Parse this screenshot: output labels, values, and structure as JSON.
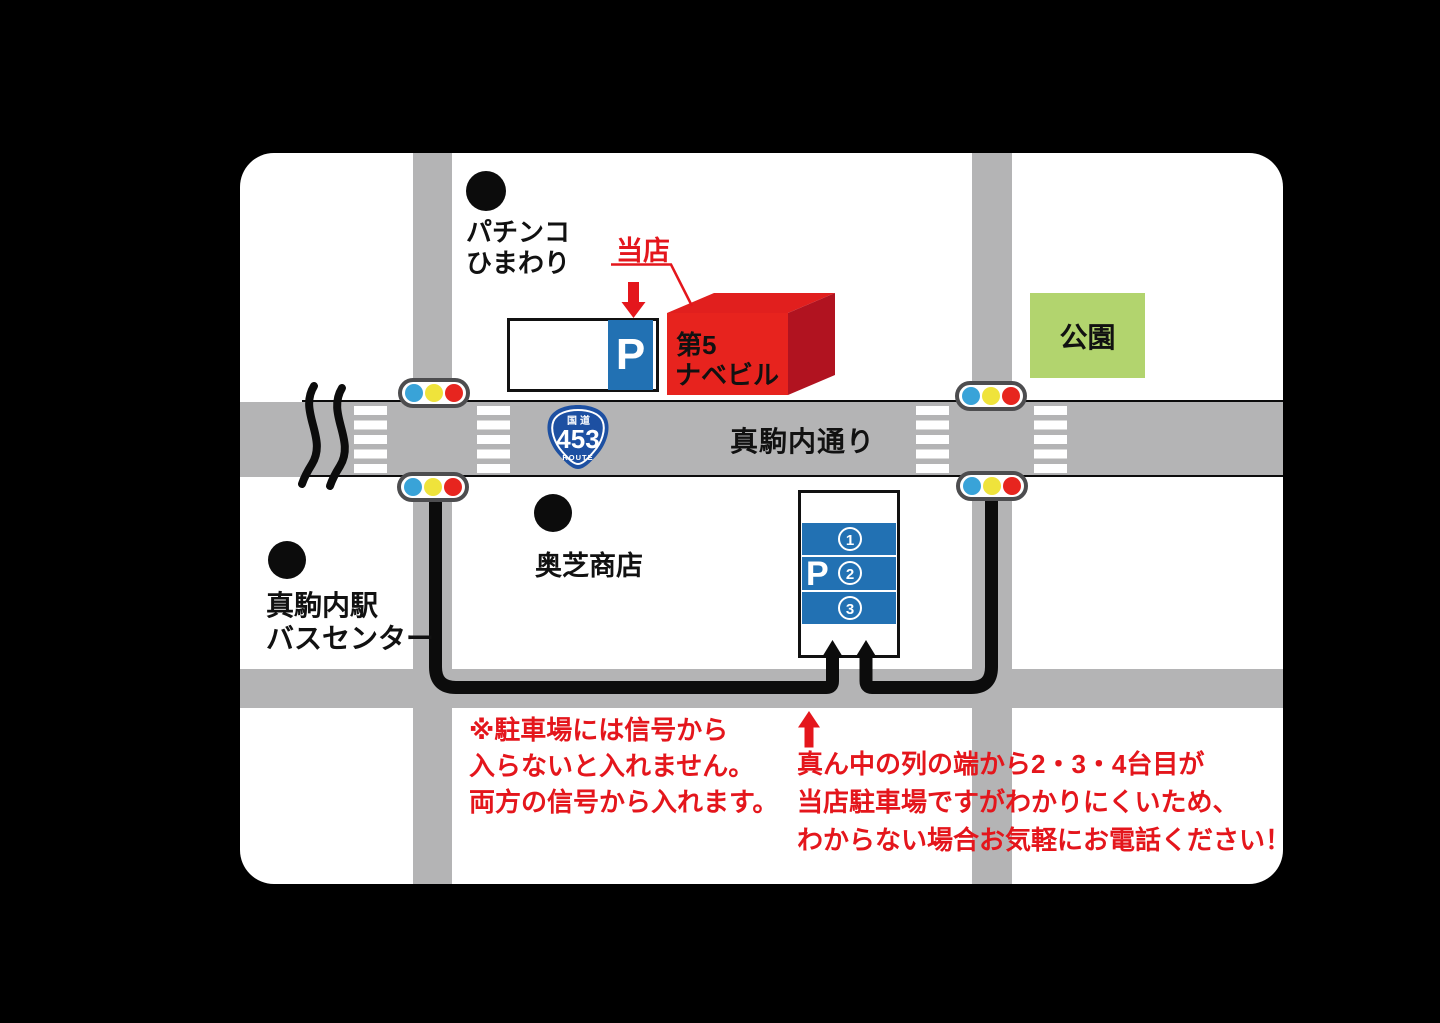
{
  "colors": {
    "background": "#000000",
    "panel": "#ffffff",
    "road_gray": "#b4b4b5",
    "accent_red": "#e4161c",
    "building_front_red": "#e7231e",
    "building_side_red": "#b11320",
    "parking_blue": "#2271b3",
    "route_badge_blue": "#1d50a2",
    "park_green": "#b2d46e",
    "signal_blue": "#39a3d8",
    "signal_yellow": "#efe33b",
    "signal_red": "#e7251f"
  },
  "landmarks": {
    "pachinko": {
      "line1": "パチンコ",
      "line2": "ひまわり"
    },
    "okushiba": {
      "label": "奥芝商店"
    },
    "station": {
      "line1": "真駒内駅",
      "line2": "バスセンター"
    },
    "park": {
      "label": "公園"
    }
  },
  "street": {
    "name": "真駒内通り"
  },
  "route_sign": {
    "top": "国道",
    "number": "453",
    "bottom": "ROUTE"
  },
  "shop": {
    "callout": "当店",
    "building_line1": "第5",
    "building_line2": "ナベビル"
  },
  "parking_top": {
    "p": "P"
  },
  "parking_lot": {
    "p": "P",
    "spots": [
      "1",
      "2",
      "3"
    ]
  },
  "notes": {
    "left": {
      "line1": "※駐車場には信号から",
      "line2": "入らないと入れません。",
      "line3": "両方の信号から入れます。"
    },
    "right": {
      "line1": "真ん中の列の端から2・3・4台目が",
      "line2": "当店駐車場ですがわかりにくいため、",
      "line3": "わからない場合お気軽にお電話ください！"
    }
  }
}
